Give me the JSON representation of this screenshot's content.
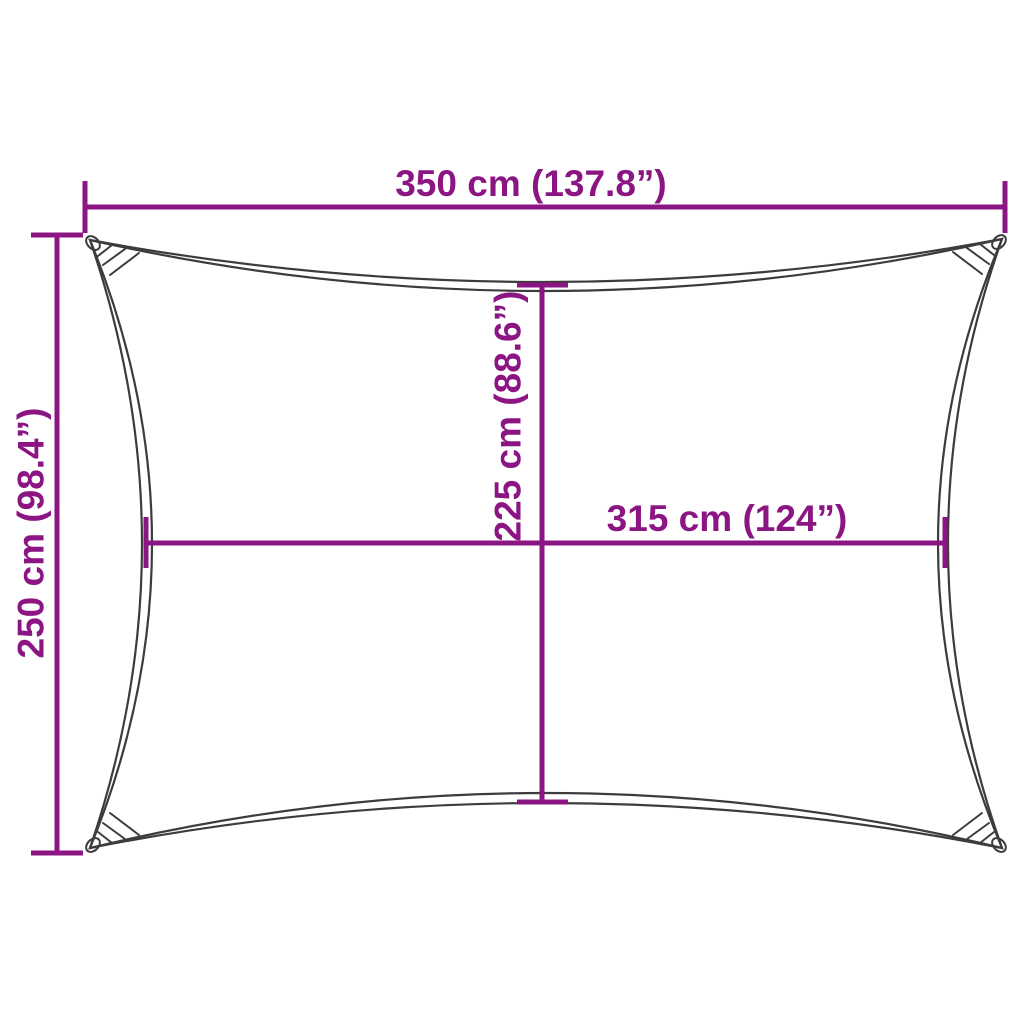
{
  "diagram": {
    "background": "#ffffff",
    "outline_color": "#3c3c3c",
    "dimension_color": "#8b1583",
    "shape": "rectangular-shade-sail-outline",
    "icons": {
      "corner_grommet": "ellipse-ring",
      "corner_stitching": "cross-hatch-lines"
    },
    "dimensions": {
      "top_width": {
        "label": "350 cm (137.8”)",
        "orientation": "horizontal",
        "position": "top"
      },
      "left_height": {
        "label": "250 cm (98.4”)",
        "orientation": "vertical",
        "position": "left"
      },
      "center_height": {
        "label": "225 cm (88.6”)",
        "orientation": "vertical",
        "position": "center"
      },
      "middle_width": {
        "label": "315 cm (124”)",
        "orientation": "horizontal",
        "position": "middle"
      }
    }
  }
}
